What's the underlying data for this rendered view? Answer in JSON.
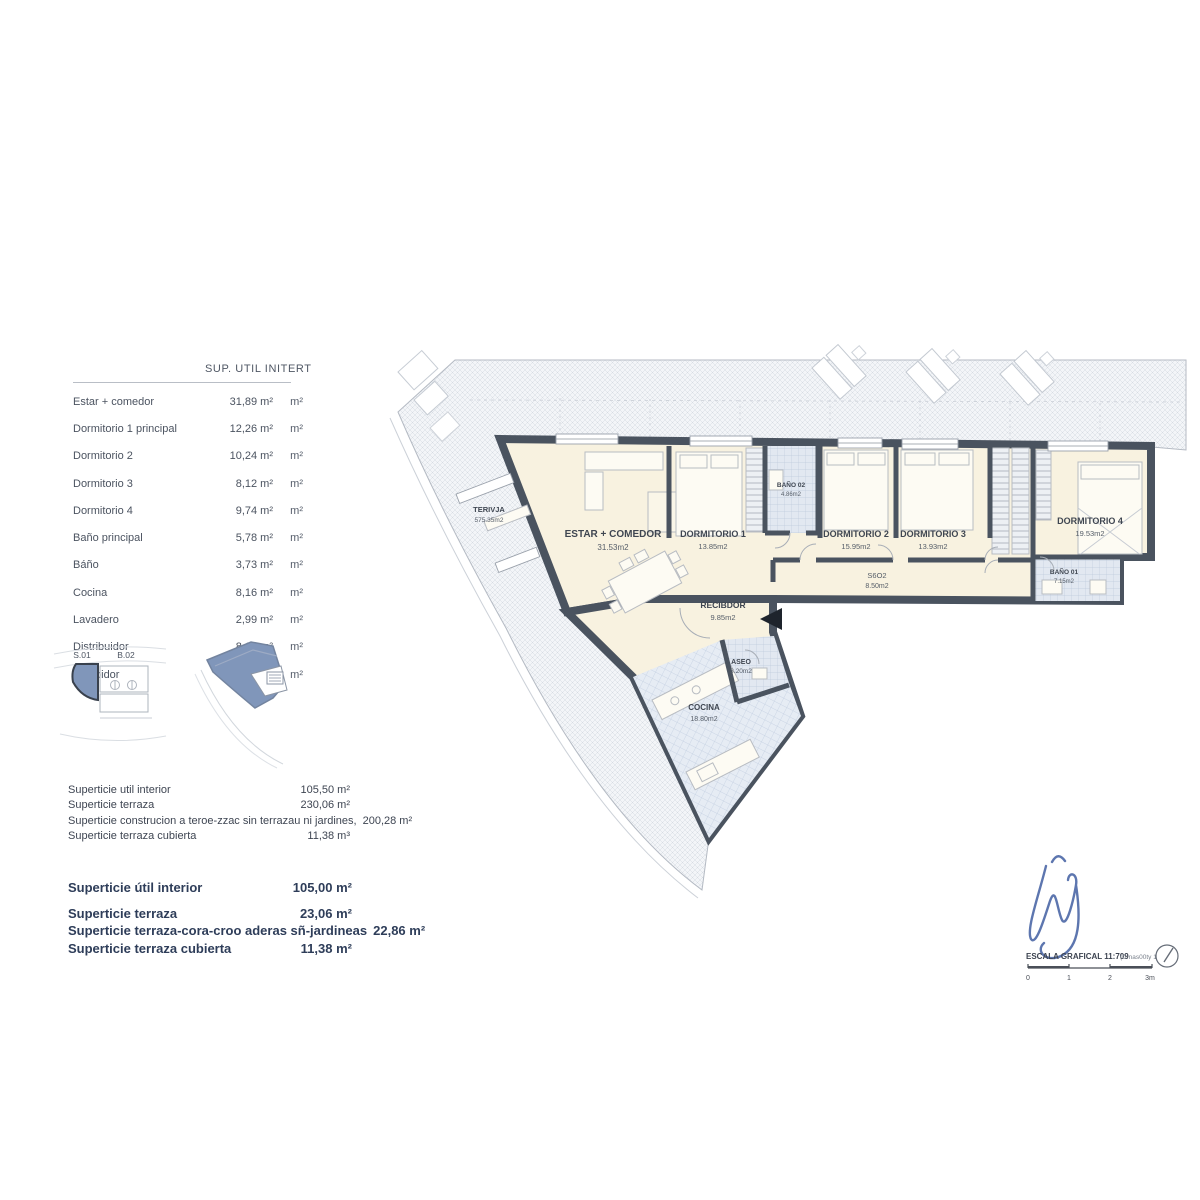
{
  "area_table": {
    "title": "SUP.  UTIL  INITERT",
    "rows": [
      {
        "label": "Estar + comedor",
        "value": "31,89 m²",
        "unit": "m²"
      },
      {
        "label": "Dormitorio 1 principal",
        "value": "12,26 m²",
        "unit": "m²"
      },
      {
        "label": "Dormitorio 2",
        "value": "10,24 m²",
        "unit": "m²"
      },
      {
        "label": "Dormitorio 3",
        "value": "8,12 m²",
        "unit": "m²"
      },
      {
        "label": "Dormitorio 4",
        "value": "9,74 m²",
        "unit": "m²"
      },
      {
        "label": "Baño principal",
        "value": "5,78 m²",
        "unit": "m²"
      },
      {
        "label": "Báño",
        "value": "3,73 m²",
        "unit": "m²"
      },
      {
        "label": "Cocina",
        "value": "8,16 m²",
        "unit": "m²"
      },
      {
        "label": "Lavadero",
        "value": "2,99 m²",
        "unit": "m²"
      },
      {
        "label": "Distribuidor",
        "value": "8,67 m²",
        "unit": "m²"
      },
      {
        "label": "Recibidor",
        "value": "7,42 m²",
        "unit": "m²"
      }
    ]
  },
  "key_plans": {
    "label_left": "S.01",
    "label_right": "B.02"
  },
  "summary_small": {
    "rows": [
      {
        "label": "Superticie util interior",
        "value": "105,50 m²"
      },
      {
        "label": "Superticie terraza",
        "value": "230,06 m²"
      },
      {
        "label": "Superticie construcion a teroe-zzac sin terrazau ni jardines,",
        "value": "200,28 m²"
      },
      {
        "label": "Superticie terraza cubierta",
        "value": "11,38 m³"
      }
    ]
  },
  "summary_bold": {
    "rows": [
      {
        "label": "Superticie útil interior",
        "value": "105,00 m²"
      },
      {
        "label": "Superticie terraza",
        "value": "23,06 m²"
      },
      {
        "label": "Superticie terraza-cora-croo aderas sñ-jardineas",
        "value": "22,86 m²"
      },
      {
        "label": "Superticie terraza cubierta",
        "value": "11,38 m²"
      }
    ]
  },
  "plan": {
    "rooms": {
      "terraza": {
        "name": "TERIVJA",
        "area": "575.35m2"
      },
      "estar": {
        "name": "ESTAR + COMEDOR",
        "area": "31.53m2"
      },
      "dorm1": {
        "name": "DORMITORIO 1",
        "area": "13.85m2"
      },
      "bano02": {
        "name": "BAÑO 02",
        "area": "4.86m2"
      },
      "dorm2": {
        "name": "DORMITORIO 2",
        "area": "15.95m2"
      },
      "dorm3": {
        "name": "DORMITORIO 3",
        "area": "13.93m2"
      },
      "dorm4": {
        "name": "DORMITORIO 4",
        "area": "19.53m2"
      },
      "bano01": {
        "name": "BAÑO 01",
        "area": "7.15m2"
      },
      "pasillo": {
        "name": "S6O2",
        "area": "8.50m2"
      },
      "recibidor": {
        "name": "RECIBDOR",
        "area": "9.85m2"
      },
      "aseo": {
        "name": "ASEO",
        "area": "3.20m2"
      },
      "cocina": {
        "name": "COCINA",
        "area": "18.80m2"
      }
    },
    "scale": {
      "caption": "ESCALA GRAFICAL 11:709",
      "note": "(C nas00ty 1",
      "ticks": [
        "0",
        "1",
        "2",
        "3m"
      ]
    }
  },
  "colors": {
    "wall": "#4a535f",
    "room_floor": "#f8f2e0",
    "tile": "#e2e8f1",
    "keyplan_blue": "#8096ba",
    "signature_blue": "#4f6aa8",
    "text": "#4b5360",
    "text_bold": "#2e3d59"
  }
}
